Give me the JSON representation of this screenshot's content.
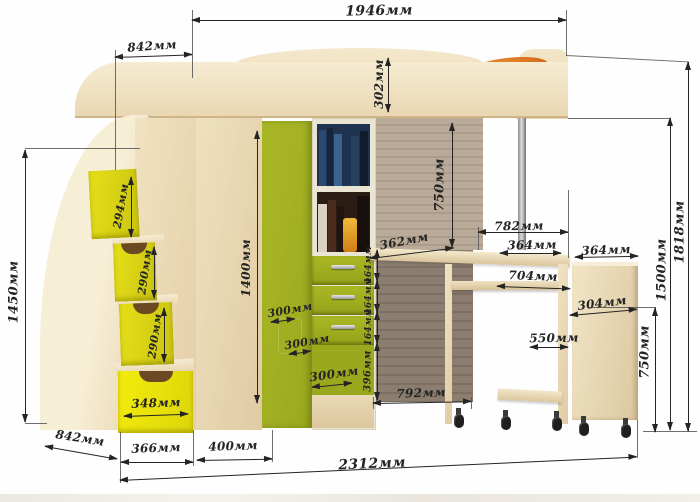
{
  "unit": "мм",
  "colors": {
    "ink": "#242424",
    "wood": "#f2e6ca",
    "wood_dark": "#e0cba2",
    "green": "#9aa81e",
    "yellow": "#e4de12",
    "orange": "#d96f1e",
    "panel_upper": "#b9aa99",
    "panel_lower": "#8b7d6f"
  },
  "dims": {
    "bed_length": "1946мм",
    "top_depth": "842мм",
    "rail_height": "302мм",
    "stairs_height": "1450мм",
    "step_1": "294мм",
    "step_2": "290мм",
    "step_3": "290мм",
    "step_drawer_width": "348мм",
    "bottom_depth": "842мм",
    "bottom_w1": "366мм",
    "bottom_w2": "400мм",
    "total_width": "2312мм",
    "wardrobe_height": "1400мм",
    "depth_a": "300мм",
    "depth_b": "300мм",
    "depth_c": "300мм",
    "drawer_1": "164мм",
    "drawer_2": "164мм",
    "drawer_3": "164мм",
    "under_drawers": "396мм",
    "underbed_height": "750мм",
    "desk_depth": "362мм",
    "underdesk_width": "792мм",
    "desk_span": "782мм",
    "desk_overhang": "364мм",
    "mobile_width": "704мм",
    "mobile_inner": "550мм",
    "cabinet_top": "364мм",
    "cabinet_depth": "304мм",
    "desk_height": "750мм",
    "bed_height": "1500мм",
    "total_height": "1818мм"
  }
}
